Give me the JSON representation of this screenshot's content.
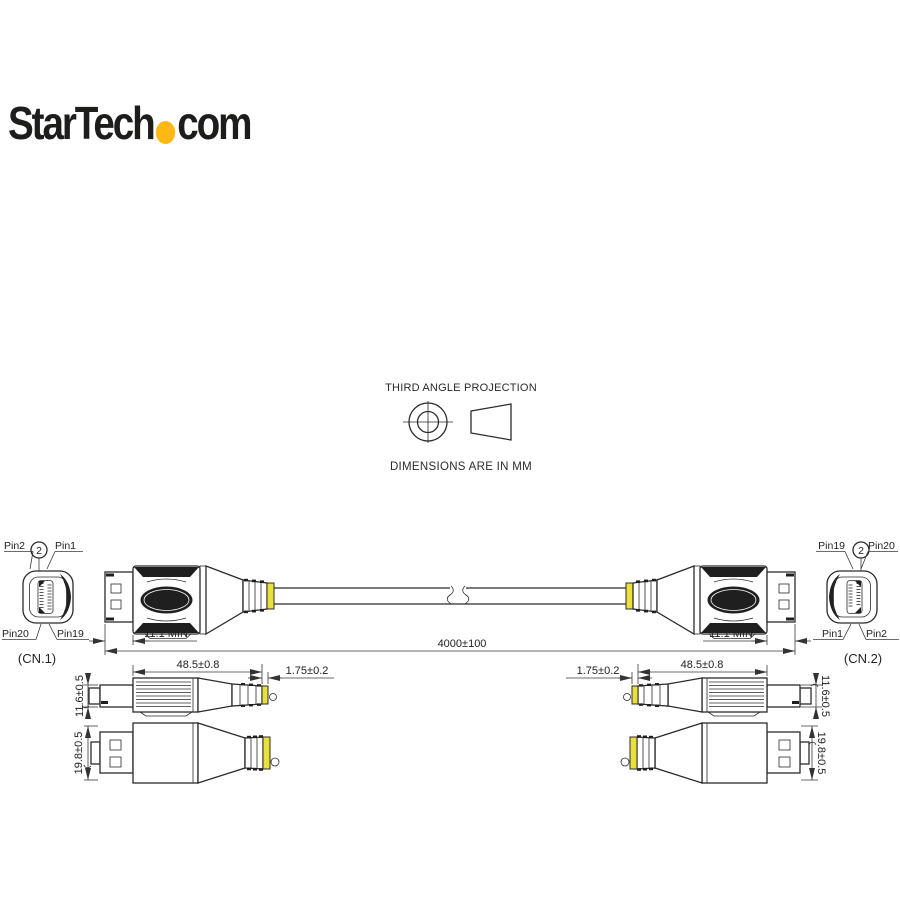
{
  "logo": {
    "prefix": "StarTech",
    "suffix": "com",
    "dot_color": "#FDB813"
  },
  "projection": {
    "title": "THIRD ANGLE PROJECTION",
    "units_note": "DIMENSIONS ARE IN MM"
  },
  "assembly": {
    "brand_left": "StarTech.com",
    "brand_right": "StarTech.com",
    "dim_plug_left": "11.1 MIN",
    "dim_plug_right": "11.1 MIN",
    "dim_cable": "4000±100"
  },
  "cn1": {
    "label": "(CN.1)",
    "callout": "2",
    "pin_top_left": "Pin2",
    "pin_top_right": "Pin1",
    "pin_bottom_left": "Pin20",
    "pin_bottom_right": "Pin19"
  },
  "cn2": {
    "label": "(CN.2)",
    "callout": "2",
    "pin_top_left": "Pin19",
    "pin_top_right": "Pin20",
    "pin_bottom_left": "Pin1",
    "pin_bottom_right": "Pin2"
  },
  "side_view_left": {
    "dim_length": "48.5±0.8",
    "dim_band": "1.75±0.2",
    "dim_height": "11.6±0.5"
  },
  "side_view_right": {
    "dim_length": "48.5±0.8",
    "dim_band": "1.75±0.2",
    "dim_height": "11.6±0.5"
  },
  "top_view_left": {
    "dim_height": "19.8±0.5"
  },
  "top_view_right": {
    "dim_height": "19.8±0.5"
  },
  "colors": {
    "line": "#2b2b2b",
    "band_yellow": "#E8E13C",
    "logo_dot": "#FDB813"
  }
}
